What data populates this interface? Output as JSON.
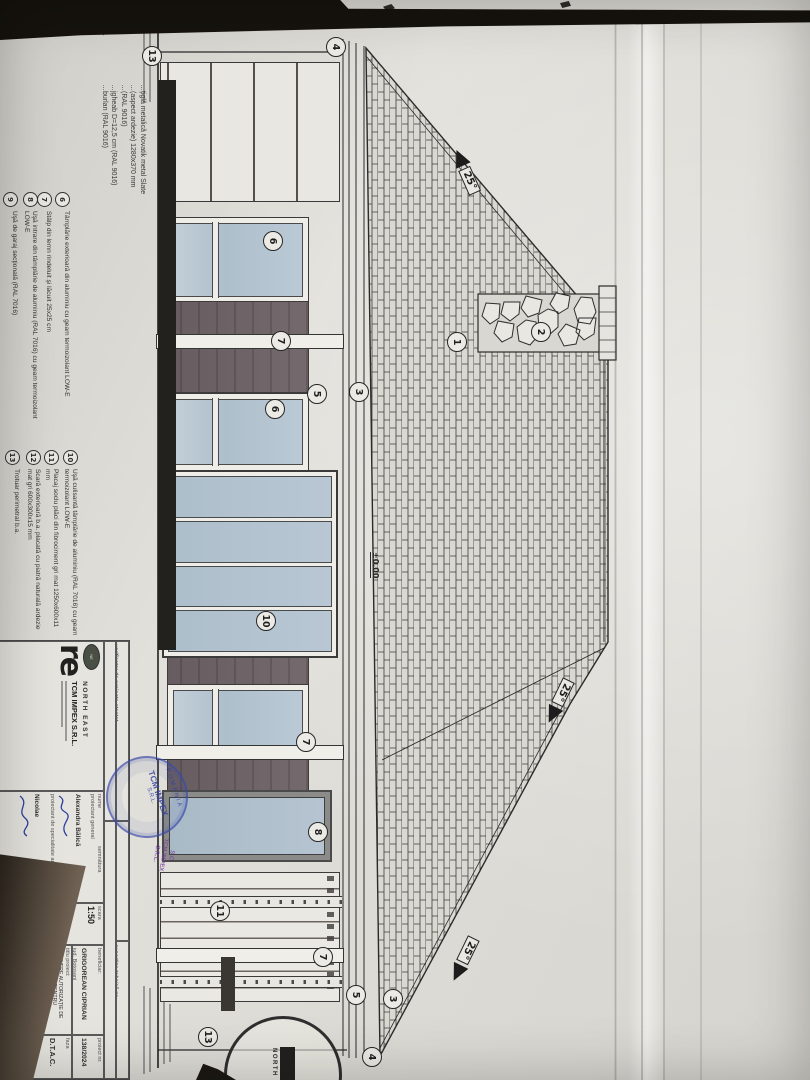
{
  "drawing": {
    "slope_labels": [
      {
        "text": "25°"
      },
      {
        "text": "25°"
      },
      {
        "text": "25°"
      }
    ],
    "elevation_label": "±0.00",
    "callouts": [
      {
        "n": "13"
      },
      {
        "n": "4"
      },
      {
        "n": "6"
      },
      {
        "n": "7"
      },
      {
        "n": "6"
      },
      {
        "n": "5"
      },
      {
        "n": "3"
      },
      {
        "n": "1"
      },
      {
        "n": "2"
      },
      {
        "n": "10"
      },
      {
        "n": "7"
      },
      {
        "n": "8"
      },
      {
        "n": "11"
      },
      {
        "n": "7"
      },
      {
        "n": "5"
      },
      {
        "n": "3"
      },
      {
        "n": "4"
      },
      {
        "n": "13"
      }
    ],
    "legend": {
      "heading_fragment": "NICA",
      "fragments": [
        "…ţiglă metalică Novatik metal Slate",
        "…(aspect ardezie) 1280x370 mm",
        "…(RAL 9016)",
        "…jgheab D=12,5 cm (RAL 9016)",
        "…burlan (RAL 9016)"
      ],
      "items": [
        {
          "n": "6",
          "text": "Tâmplărie exterioară din aluminiu cu geam termoizolant LOW-E"
        },
        {
          "n": "7",
          "text": "Stâlp din lemn rindeluit şi lăcuit 25x25 cm"
        },
        {
          "n": "8",
          "text": "Uşă intrare din tâmplărie de aluminiu (RAL 7016) cu geam termoizolant LOW-E"
        },
        {
          "n": "9",
          "text": "Uşă de garaj secţională (RAL 7016)"
        },
        {
          "n": "10",
          "text": "Uşă culisantă tâmplărie de aluminiu (RAL 7016) cu geam termoizolant LOW-E"
        },
        {
          "n": "11",
          "text": "Placaj soclu plăci din fibrociment gri mat 1250x600x11 mm"
        },
        {
          "n": "12",
          "text": "Scară exterioară b.a. placată cu piatră naturală ardezie mat gri 600x300x15 mm"
        },
        {
          "n": "13",
          "text": "Trotuar perimetral b.a."
        }
      ]
    },
    "title_block": {
      "verificator": "verificator de proiecte atestat",
      "expertiza": "expertiza tehnică nr.",
      "revizia": "revizia",
      "company": "TCM IMPEX S.R.L.",
      "company_brand": "NORTH EAST",
      "nume_label": "nume",
      "semnatura_label": "semnătura",
      "r1_label": "proiectant general",
      "r1_name": "Alexandra Bălică",
      "r2_label": "proiectant de specialitate arh.",
      "r2_name": "Nicolae",
      "scara_label": "scara",
      "scara_value": "1:50",
      "data_label": "data",
      "data_value": "2024",
      "beneficiar_label": "beneficiar:",
      "beneficiar_name": "GRIGOREAN CIPRIAN",
      "beneficiar_sub": "jud. Botoşani",
      "titlu_label": "titlu proiect:",
      "titlu_line1": "OBŢINERE AUTORIZAŢIE DE CONSTRUIRE PENTRU LOCUINŢĂ, GARAJ,",
      "titlu_line2": "ÎMPREJMUIRE TEREN ŞI RACORDURI / BRANŞAMENTE UTILITĂŢI",
      "denumire_label": "denumire plan:",
      "denumire_value": "FAŢADĂ POSTERIOARĂ",
      "proiect_label": "proiect nr.",
      "proiect_value": "138/2024",
      "faza_label": "faza",
      "faza_value": "D.T.A.C.",
      "plansa_label": "planşa nr.",
      "plansa_value": "A.08"
    }
  },
  "stamps": {
    "round_rim": "ROMÂNIA",
    "round_center": "TCM IMPEX",
    "round_sub": "S.R.L.",
    "purple_line1": "S.C.",
    "purple_line2": "TCM IMPEX",
    "purple_line3": "S.R.L.",
    "corner_text": "NORTH EAST"
  }
}
